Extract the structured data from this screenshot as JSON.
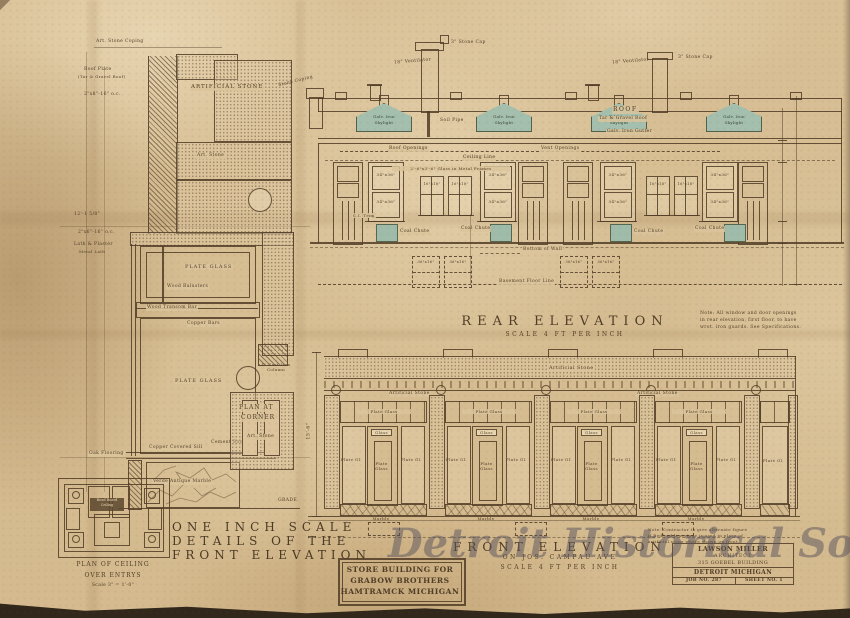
{
  "watermark": "Detroit Historical Society",
  "detail": {
    "title": [
      "ONE INCH SCALE",
      "DETAILS OF THE",
      "FRONT ELEVATION"
    ],
    "coping": "Art. Stone Coping",
    "roof_plate": "Roof Plate",
    "roof_felt": "(Tar & Gravel Roof)",
    "joists_roof": "2\"x8\"-16\" o.c.",
    "artificial_stone": "ARTIFICIAL STONE",
    "art_stone": "Art. Stone",
    "dim_height": "12'-1 5/8\"",
    "joists_ceil": "2\"x6\"-16\" o.c.",
    "lath_plaster": "Lath & Plaster",
    "metal_lath": "Metal Lath",
    "plate_glass": "PLATE GLASS",
    "wood_balusters": "Wood Balusters",
    "wood_transom_bar": "Wood Transom Bar",
    "copper_bars": "Copper Bars",
    "cast_iron_column": "4\" Cast Iron Column",
    "plan_at_corner": [
      "PLAN AT",
      "CORNER"
    ],
    "oak_flooring": "Oak Flooring",
    "copper_sill": "Copper Covered Sill",
    "cement_base": "Cement Base",
    "verde_marble": "Verde Antique Marble",
    "grade": "GRADE"
  },
  "ceiling_plan": {
    "label": [
      "Bead Board",
      "Ceiling"
    ],
    "caption": [
      "PLAN OF CEILING",
      "OVER ENTRYS",
      "Scale 3\" = 1'-0\""
    ]
  },
  "rear": {
    "title": "REAR ELEVATION",
    "scale": "SCALE 4 FT PER INCH",
    "stone_coping": "Stone Coping",
    "stone_cap": "3\" Stone Cap",
    "ventilator": "18\" Ventilator",
    "skylight": [
      "Galv. Iron",
      "Skylight"
    ],
    "roof": "ROOF",
    "roof_type": "Tar & Gravel Roof",
    "gutter": "Galv. Iron Gutter",
    "soil_pipe": "Soil Pipe",
    "roof_openings": "Roof Openings",
    "vent_openings": "Vent Openings",
    "ceiling_line": "Ceiling Line",
    "window_dim": "34\"x36\"",
    "small_window_dim": "16\"x18\"",
    "metal_frames": "2'-6\"x3'-6\" Glass in Metal Frames",
    "ci_trim": "C.I. Trim",
    "coal_chute": "Coal Chute",
    "bottom_of_wall": "Bottom of Wall",
    "bsmt_window_dim": "36\"x16\"",
    "bsmt_floor_line": "Basement Floor Line",
    "note": [
      "Note: All window and door openings",
      "in rear elevation, first floor, to have",
      "wrot. iron guards. See Specifications."
    ]
  },
  "front": {
    "title": "FRONT ELEVATION",
    "subtitle": "ON JOS. CAMPAU AVE",
    "scale": "SCALE 4 FT PER INCH",
    "artificial_stone": "Artificial Stone",
    "plate_glass": "Plate Glass",
    "plate_gl": "Plate Gl.",
    "glass": "Glass",
    "marble": "Marble",
    "height_dim": "15'-6\"",
    "note": [
      "Note: Contractor to give alternate figure",
      "if Bedford limestone is used in place of",
      "artificial stone where shown on front."
    ]
  },
  "title_block": [
    "STORE BUILDING FOR",
    "GRABOW BROTHERS",
    "HAMTRAMCK MICHIGAN"
  ],
  "architect_block": {
    "name": "LAWSON MILLER",
    "role": "ARCHITECT",
    "address": "315 GOEBEL BUILDING",
    "city": "DETROIT MICHIGAN",
    "job": "JOB NO. 287",
    "sheet": "SHEET NO. 1"
  }
}
